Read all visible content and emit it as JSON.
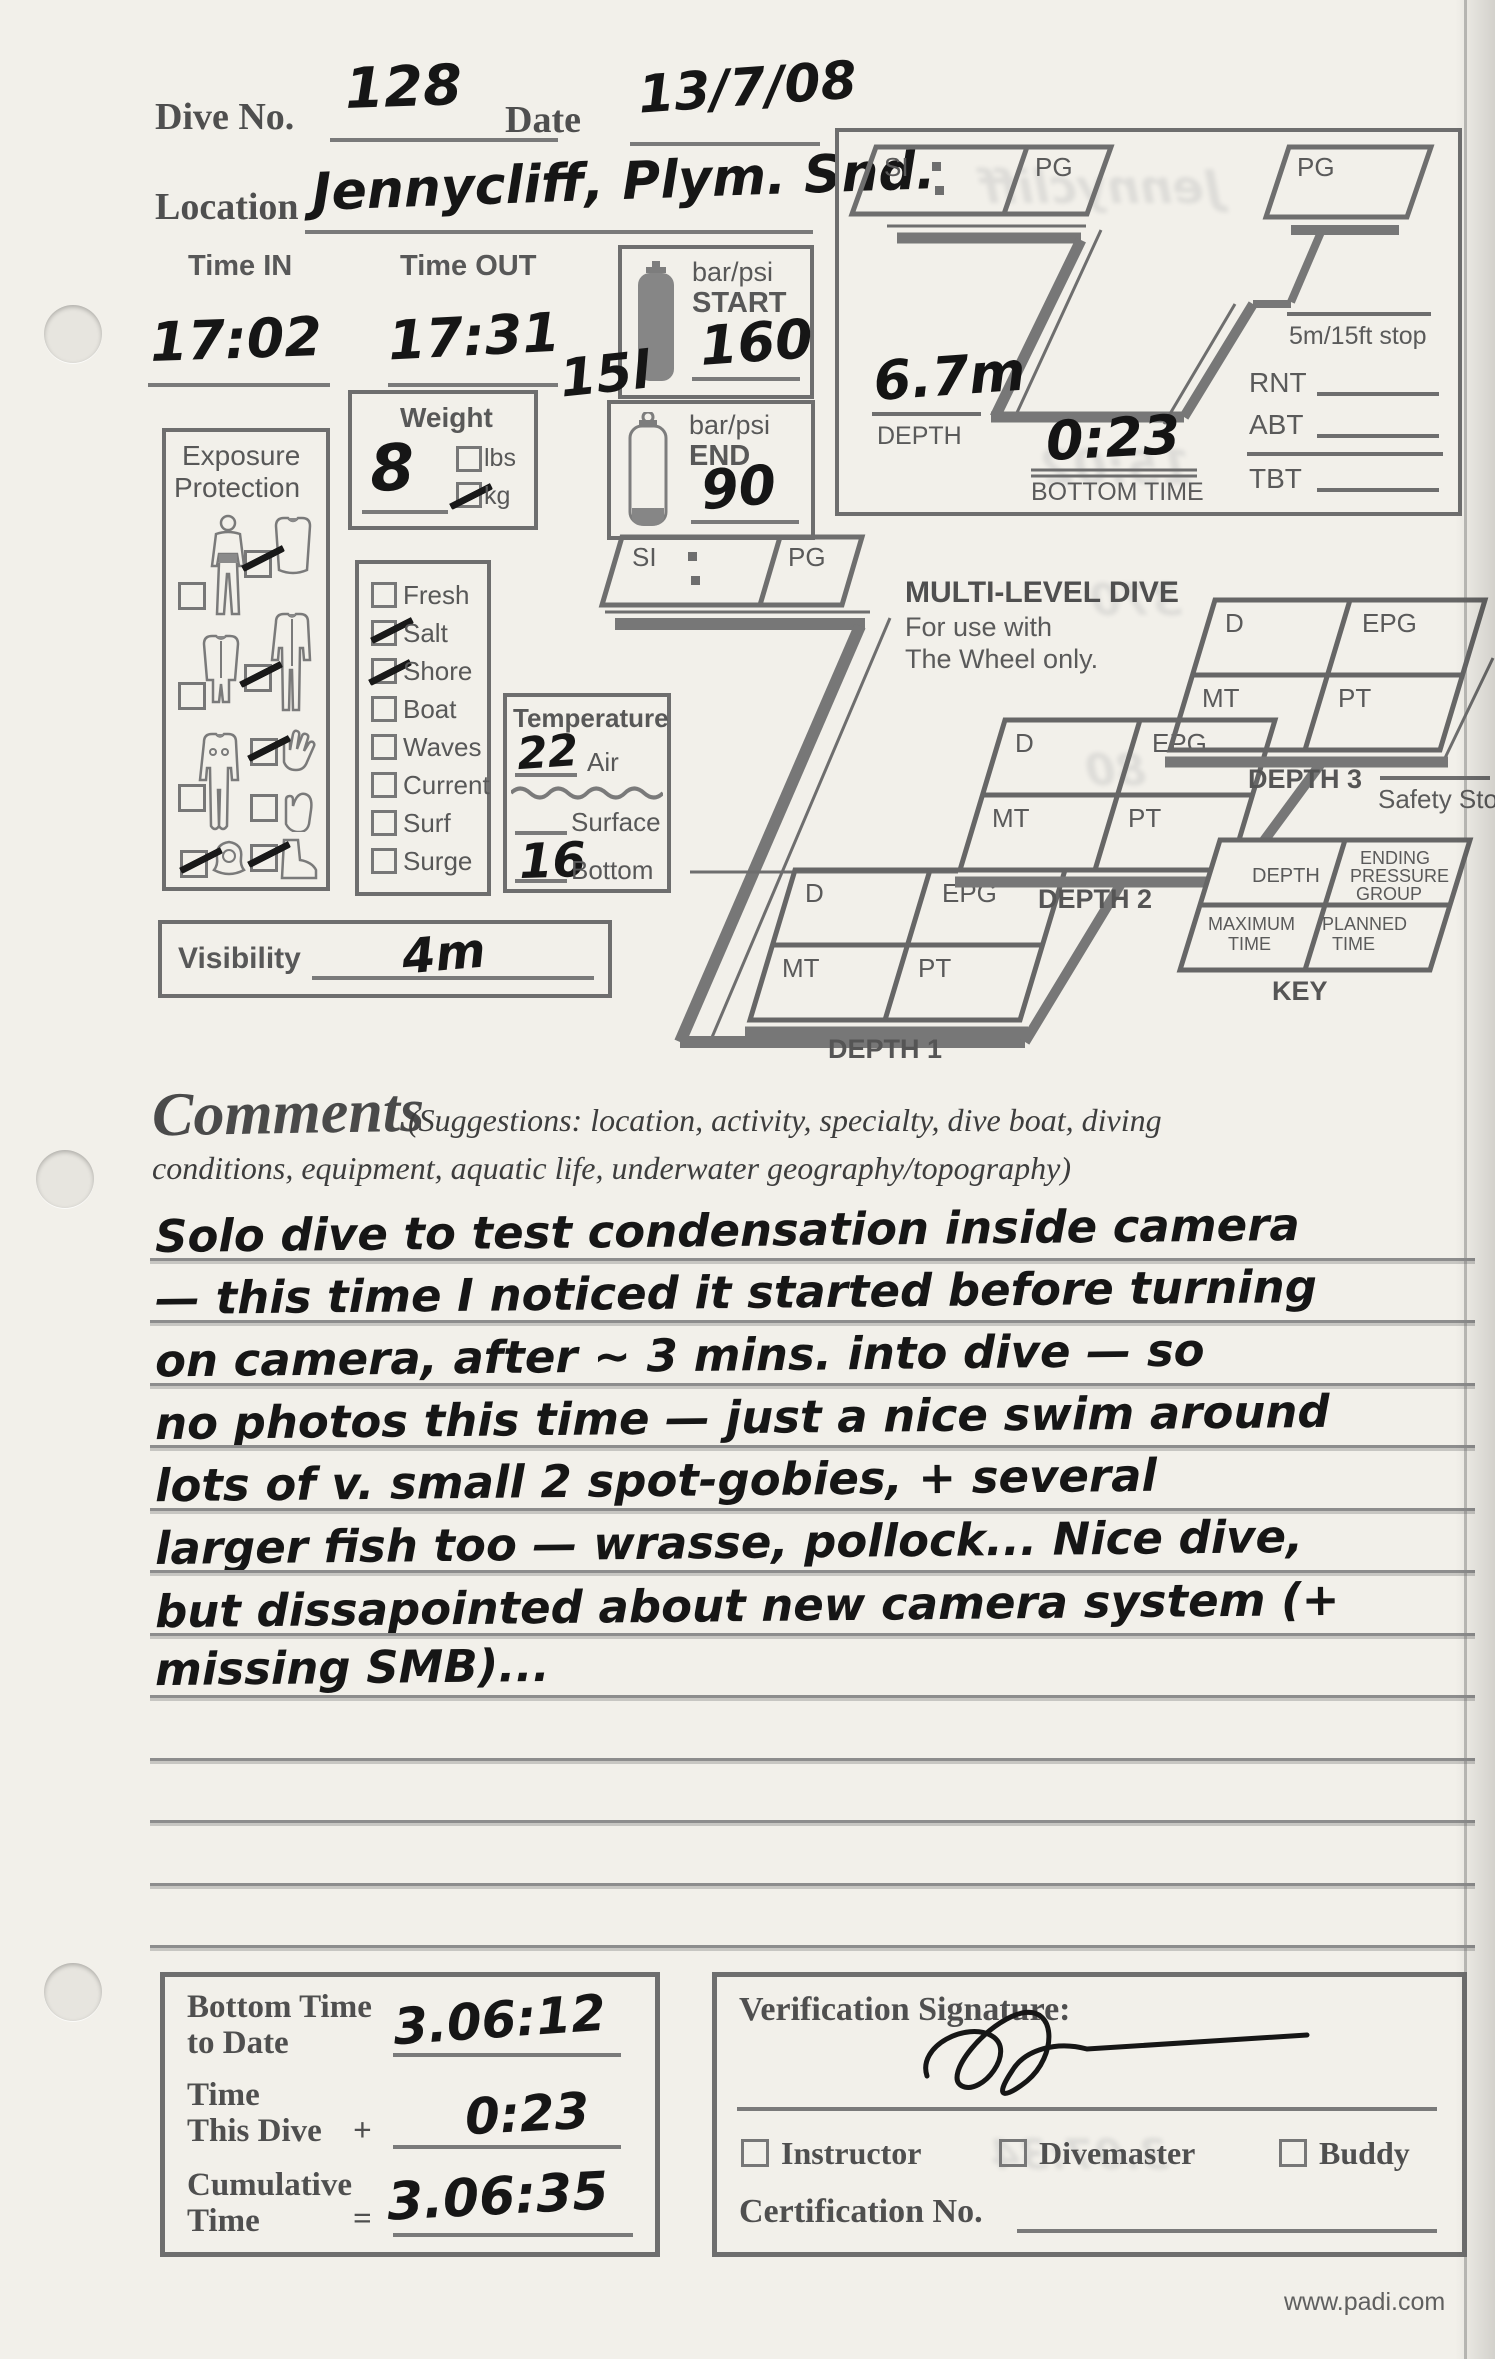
{
  "header": {
    "dive_no_label": "Dive No.",
    "dive_no_value": "128",
    "date_label": "Date",
    "date_value": "13/7/08",
    "location_label": "Location",
    "location_value": "Jennycliff, Plym. Snd."
  },
  "times": {
    "time_in_label": "Time IN",
    "time_in_value": "17:02",
    "time_out_label": "Time OUT",
    "time_out_value": "17:31"
  },
  "tank": {
    "unit_label": "bar/psi",
    "start_label": "START",
    "start_value": "160",
    "size_note": "15l",
    "end_label": "END",
    "end_value": "90"
  },
  "weight": {
    "label": "Weight",
    "value": "8",
    "lbs_label": "lbs",
    "lbs_checked": false,
    "kg_label": "kg",
    "kg_checked": true
  },
  "exposure": {
    "title_line1": "Exposure",
    "title_line2": "Protection",
    "items": [
      {
        "name": "swimsuit",
        "checked": false
      },
      {
        "name": "vest",
        "checked": true
      },
      {
        "name": "shorty-suit",
        "checked": false
      },
      {
        "name": "full-suit",
        "checked": true
      },
      {
        "name": "dry-suit",
        "checked": false
      },
      {
        "name": "gloves",
        "checked": true
      },
      {
        "name": "mitts",
        "checked": false
      },
      {
        "name": "hood",
        "checked": true
      },
      {
        "name": "boots",
        "checked": true
      }
    ]
  },
  "water": {
    "options": [
      {
        "label": "Fresh",
        "checked": false
      },
      {
        "label": "Salt",
        "checked": true
      },
      {
        "label": "Shore",
        "checked": true
      },
      {
        "label": "Boat",
        "checked": false
      },
      {
        "label": "Waves",
        "checked": false
      },
      {
        "label": "Current",
        "checked": false
      },
      {
        "label": "Surf",
        "checked": false
      },
      {
        "label": "Surge",
        "checked": false
      }
    ]
  },
  "temperature": {
    "title": "Temperature",
    "air_value": "22",
    "air_label": "Air",
    "surface_value": "",
    "surface_label": "Surface",
    "bottom_value": "16",
    "bottom_label": "Bottom"
  },
  "visibility": {
    "label": "Visibility",
    "value": "4m"
  },
  "profile": {
    "si_label": "SI",
    "pg_label": "PG",
    "pg2_label": "PG",
    "stop_label": "5m/15ft stop",
    "depth_value": "6.7m",
    "depth_label": "DEPTH",
    "bottom_time_value": "0:23",
    "bottom_time_label": "BOTTOM TIME",
    "rnt_label": "RNT",
    "abt_label": "ABT",
    "tbt_label": "TBT"
  },
  "multilevel": {
    "si_label": "SI",
    "pg_label": "PG",
    "title": "MULTI-LEVEL DIVE",
    "subtitle1": "For use with",
    "subtitle2": "The Wheel only.",
    "d1": {
      "d": "D",
      "epg": "EPG",
      "mt": "MT",
      "pt": "PT",
      "label": "DEPTH 1"
    },
    "d2": {
      "d": "D",
      "epg": "EPG",
      "mt": "MT",
      "pt": "PT",
      "label": "DEPTH 2"
    },
    "d3": {
      "d": "D",
      "epg": "EPG",
      "mt": "MT",
      "pt": "PT",
      "label": "DEPTH 3"
    },
    "safety_stop_label": "Safety Stop",
    "key": {
      "depth": "DEPTH",
      "epg_line1": "ENDING",
      "epg_line2": "PRESSURE",
      "epg_line3": "GROUP",
      "max_line1": "MAXIMUM",
      "max_line2": "TIME",
      "plan_line1": "PLANNED",
      "plan_line2": "TIME",
      "label": "KEY"
    }
  },
  "comments": {
    "title": "Comments",
    "suggestions_line1": "(Suggestions: location, activity, specialty, dive boat, diving",
    "suggestions_line2": "conditions, equipment, aquatic life, underwater geography/topography)",
    "lines": [
      "Solo dive to test condensation inside camera",
      "— this time I noticed it started before turning",
      "on camera, after ~ 3 mins. into dive — so",
      "no photos this time — just a nice swim around",
      "lots of v. small 2 spot-gobies, + several",
      "larger fish too — wrasse, pollock... Nice dive,",
      "but dissapointed about new camera system (+",
      "missing SMB)..."
    ]
  },
  "totals": {
    "bottom_time_label1": "Bottom Time",
    "bottom_time_label2": "to Date",
    "bottom_time_value": "3.06:12",
    "this_dive_label1": "Time",
    "this_dive_label2": "This Dive",
    "plus_sign": "+",
    "this_dive_value": "0:23",
    "cumulative_label1": "Cumulative",
    "cumulative_label2": "Time",
    "equals_sign": "=",
    "cumulative_value": "3.06:35"
  },
  "verification": {
    "signature_label": "Verification Signature:",
    "roles": [
      {
        "label": "Instructor",
        "checked": false
      },
      {
        "label": "Divemaster",
        "checked": false
      },
      {
        "label": "Buddy",
        "checked": false
      }
    ],
    "cert_label": "Certification No."
  },
  "footer": {
    "website": "www.padi.com"
  },
  "bleed_through": [
    "Jennycliff",
    "15:02",
    "370",
    "80",
    "3.07:34"
  ]
}
